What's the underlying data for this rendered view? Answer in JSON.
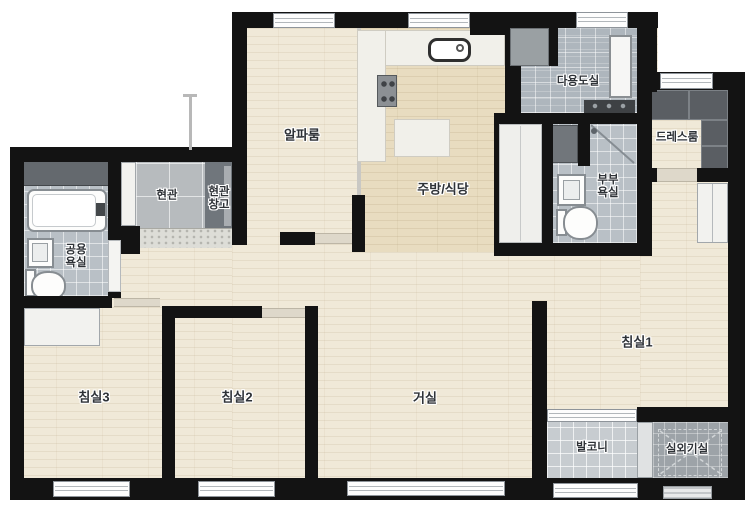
{
  "floorplan": {
    "type": "apartment-floor-plan",
    "language": "ko",
    "rooms": {
      "alpha": {
        "label": "알파룸"
      },
      "kitchen": {
        "label": "주방/식당"
      },
      "utility": {
        "label": "다용도실"
      },
      "dress": {
        "label": "드레스룸"
      },
      "master_bath": {
        "line1": "부부",
        "line2": "욕실"
      },
      "entrance": {
        "label": "현관"
      },
      "entrance_storage": {
        "line1": "현관",
        "line2": "창고"
      },
      "common_bath": {
        "line1": "공용",
        "line2": "욕실"
      },
      "bed1": {
        "label": "침실1"
      },
      "bed2": {
        "label": "침실2"
      },
      "bed3": {
        "label": "침실3"
      },
      "living": {
        "label": "거실"
      },
      "balcony": {
        "label": "발코니"
      },
      "outdoor": {
        "label": "실외기실"
      }
    },
    "colors": {
      "wall": "#131313",
      "wood_floor": "#f0e9d8",
      "kitchen_floor": "#e8dcc0",
      "bath_tile": "#b9c0c6",
      "utility_tile": "#aeb6bd",
      "entrance_tile": "#b7bbbe",
      "balcony_tile": "#c7ccd0",
      "outdoor_tile": "#9da3a8",
      "closet_dark": "#5a5e63",
      "storage_dark": "#70767c"
    }
  }
}
